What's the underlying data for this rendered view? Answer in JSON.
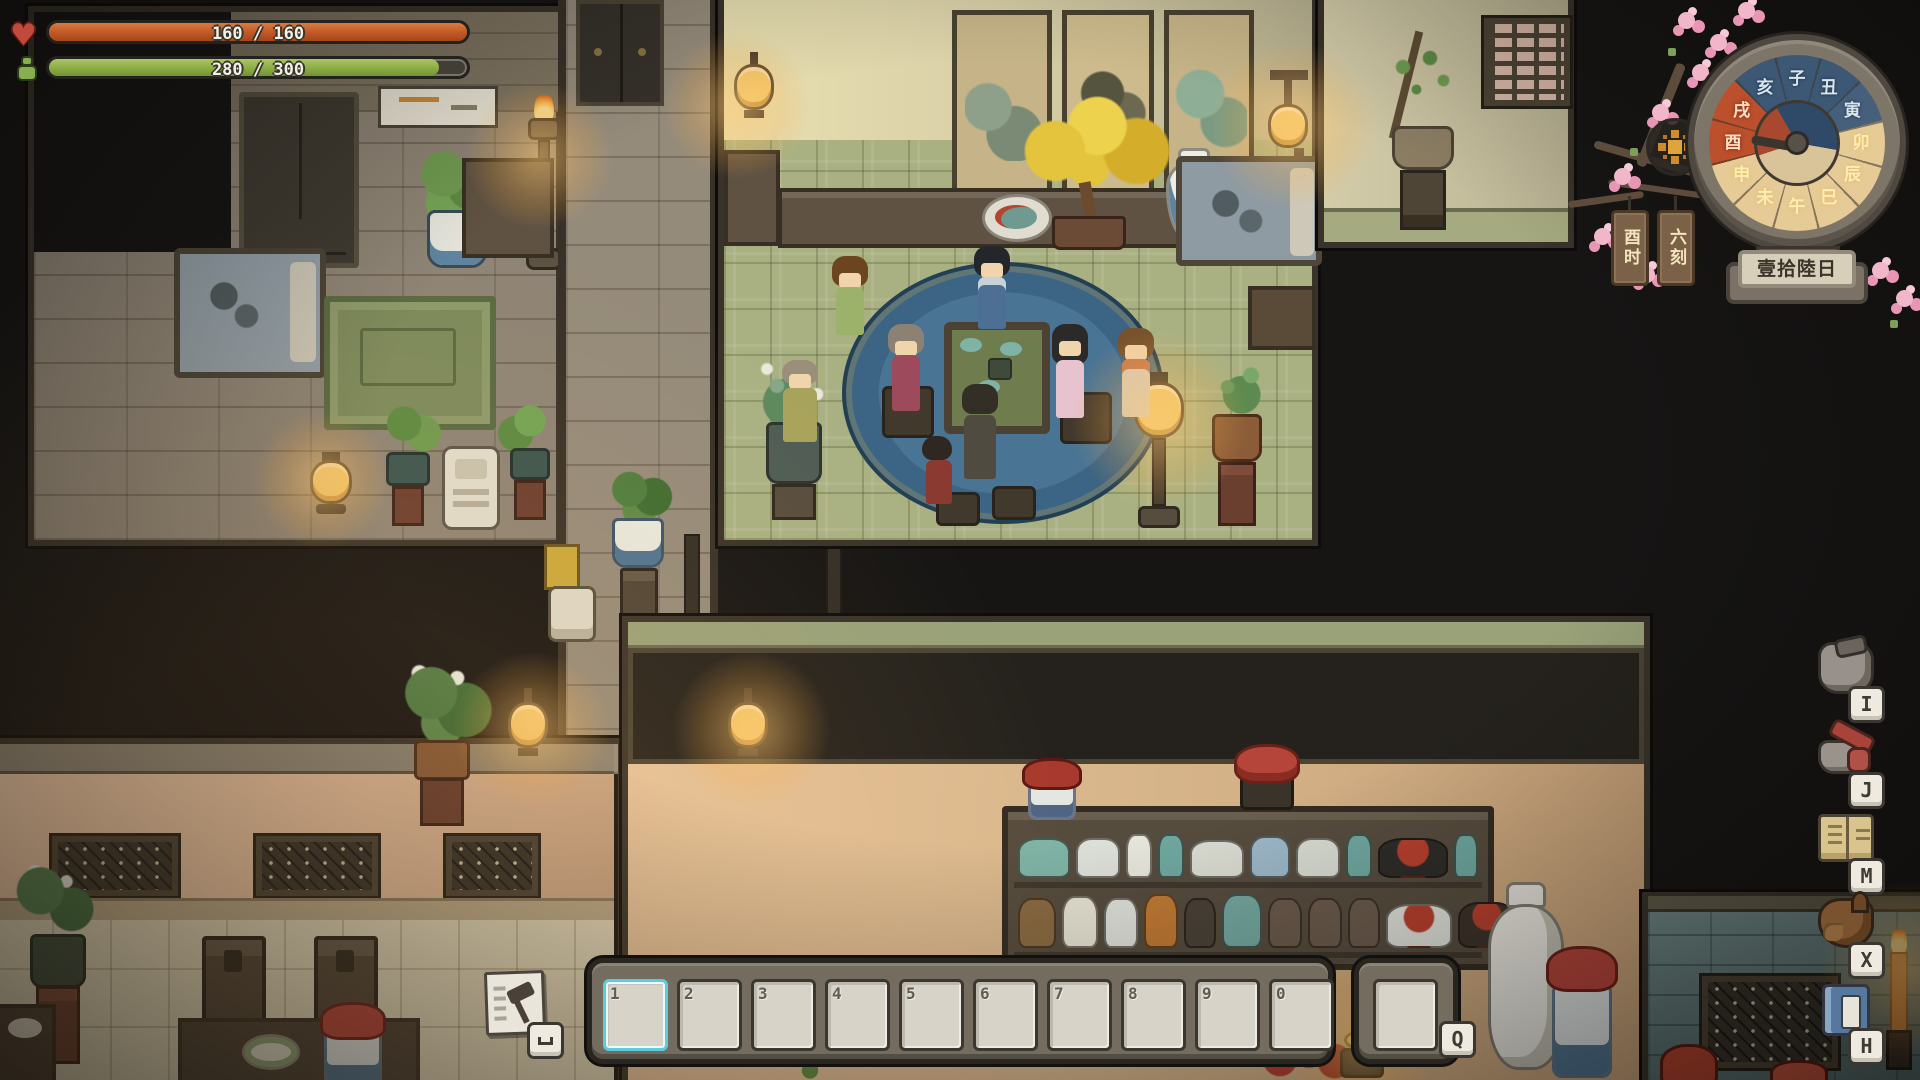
{
  "hud": {
    "health": {
      "value": "160 / 160",
      "current": 160,
      "max": 160,
      "icon": "heart-icon"
    },
    "stamina": {
      "value": "280 / 300",
      "current": 280,
      "max": 300,
      "icon": "stamina-figure-icon"
    }
  },
  "clock": {
    "segments": [
      {
        "char": "子",
        "phase": "night"
      },
      {
        "char": "丑",
        "phase": "night"
      },
      {
        "char": "寅",
        "phase": "dawn"
      },
      {
        "char": "卯",
        "phase": "day"
      },
      {
        "char": "辰",
        "phase": "day"
      },
      {
        "char": "巳",
        "phase": "day"
      },
      {
        "char": "午",
        "phase": "day"
      },
      {
        "char": "未",
        "phase": "day"
      },
      {
        "char": "申",
        "phase": "day"
      },
      {
        "char": "酉",
        "phase": "current"
      },
      {
        "char": "戌",
        "phase": "current"
      },
      {
        "char": "亥",
        "phase": "night"
      }
    ],
    "hour_tag": "酉时",
    "quarter_tag": "六刻",
    "date_plaque": "壹拾陸日",
    "sun_icon": "sun-icon"
  },
  "shortcuts": [
    {
      "key": "I",
      "icon": "pouch-icon"
    },
    {
      "key": "J",
      "icon": "tools-icon"
    },
    {
      "key": "M",
      "icon": "map-book-icon"
    },
    {
      "key": "X",
      "icon": "horse-icon"
    },
    {
      "key": "H",
      "icon": "handbook-icon"
    }
  ],
  "hotbar": {
    "slots": [
      {
        "label": "1",
        "selected": true
      },
      {
        "label": "2"
      },
      {
        "label": "3"
      },
      {
        "label": "4"
      },
      {
        "label": "5"
      },
      {
        "label": "6"
      },
      {
        "label": "7"
      },
      {
        "label": "8"
      },
      {
        "label": "9"
      },
      {
        "label": "0"
      }
    ],
    "extra_slot_key": "Q",
    "craft_sign": {
      "icon": "hammer-icon",
      "key_glyph": "⌴"
    }
  },
  "colors": {
    "health_fill": "#c9652e",
    "stamina_fill": "#93b14e",
    "selection": "#5ecbdd",
    "night_segment": "#3c5875",
    "dawn_segment": "#46607c",
    "day_segment": "#e6cb97",
    "current_segment": "#bc4f2c"
  }
}
